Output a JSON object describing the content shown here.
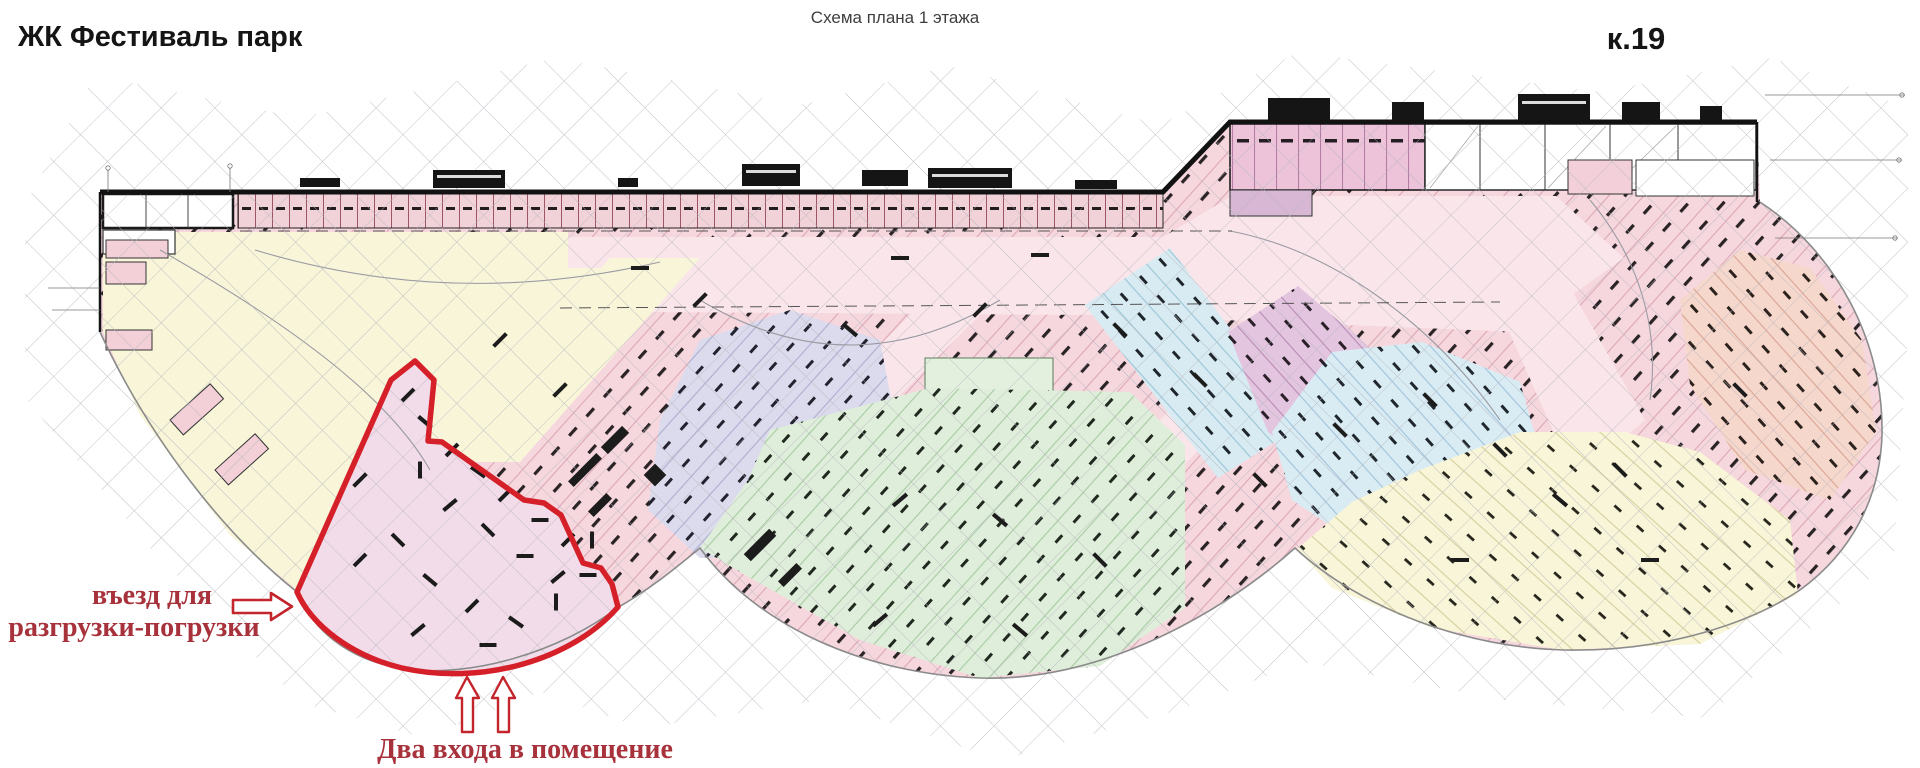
{
  "header": {
    "project_title": "ЖК Фестиваль парк",
    "drawing_title": "Схема плана 1 этажа",
    "building_label": "к.19"
  },
  "annotations": {
    "loading_entrance_line1": "въезд для",
    "loading_entrance_line2": "разгрузки-погрузки",
    "two_entrances": "Два входа в помещение"
  },
  "highlight": {
    "outline_color": "#d5202a",
    "fill_color": "#f2dce9",
    "arrow_stroke_color": "#c4242c",
    "annotation_text_color": "#a8323c"
  },
  "plan": {
    "grid_color": "#b4b4bd",
    "wall_color": "#1c1c1c",
    "lane_pink": "#fae6ea",
    "zones": [
      {
        "name": "left-utility-block",
        "color": "#ffffff"
      },
      {
        "name": "top-stall-row-pink",
        "color": "#f2d2d9"
      },
      {
        "name": "left-lane-cream",
        "color": "#f8f5d8"
      },
      {
        "name": "central-parking-pink",
        "color": "#f6d7de"
      },
      {
        "name": "central-lavender",
        "color": "#dbdbed"
      },
      {
        "name": "central-green",
        "color": "#dfeeda"
      },
      {
        "name": "mid-cyan-band",
        "color": "#d8ebf2"
      },
      {
        "name": "right-lilac-band",
        "color": "#e3c5e0"
      },
      {
        "name": "right-blue",
        "color": "#d9ecf4"
      },
      {
        "name": "top-right-magenta-band",
        "color": "#ecc3d9"
      },
      {
        "name": "far-right-salmon",
        "color": "#f6d7cc"
      },
      {
        "name": "bottom-right-cream",
        "color": "#f8f5d8"
      }
    ]
  }
}
